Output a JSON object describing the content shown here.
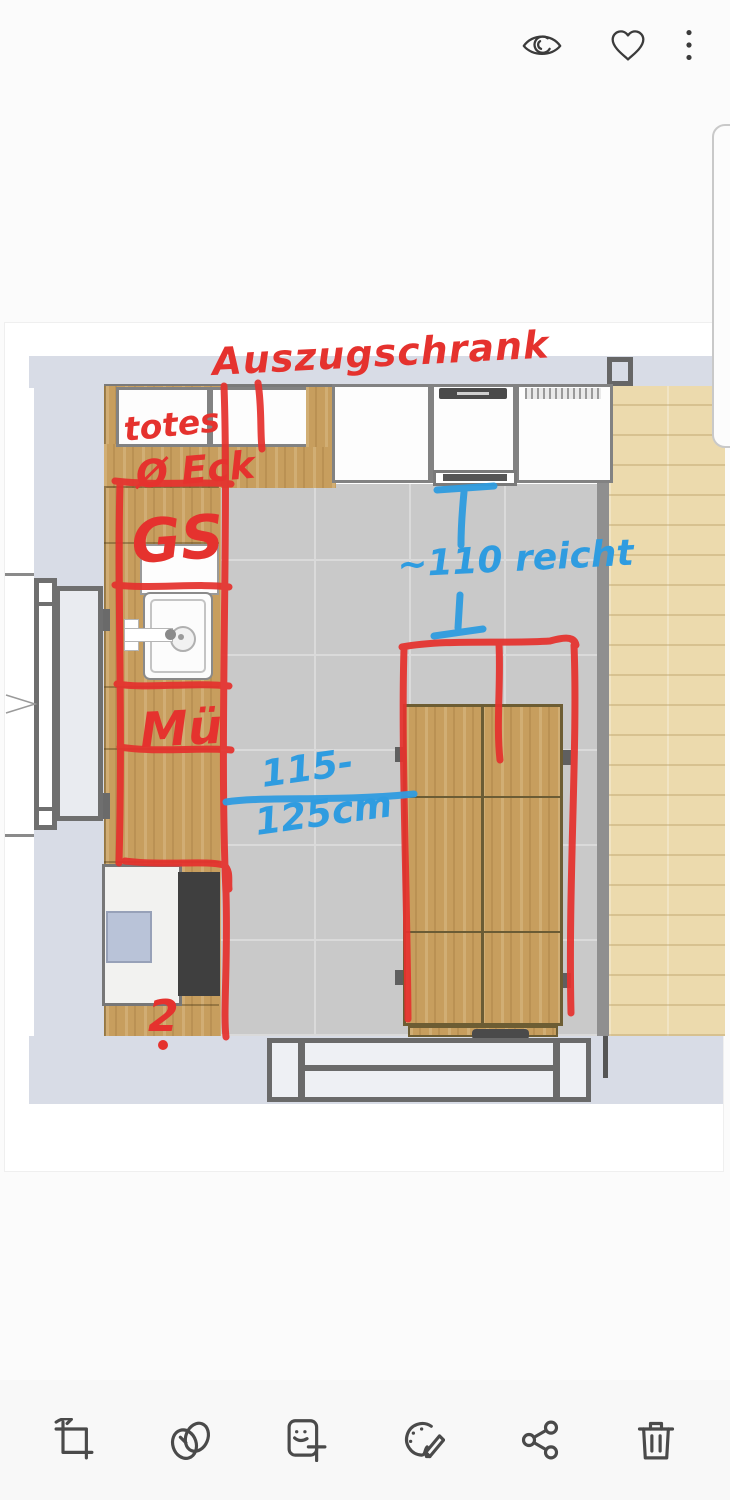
{
  "topbar": {
    "icons": [
      {
        "name": "vision-eye-icon"
      },
      {
        "name": "favorite-heart-icon"
      },
      {
        "name": "more-options-icon"
      }
    ]
  },
  "toolbar": {
    "icons": [
      {
        "name": "crop-rotate-icon"
      },
      {
        "name": "filters-icon"
      },
      {
        "name": "stickers-text-icon"
      },
      {
        "name": "draw-palette-icon"
      },
      {
        "name": "share-icon"
      },
      {
        "name": "delete-trash-icon"
      }
    ]
  },
  "annotations": {
    "red": {
      "color": "#e5322e",
      "pullout_cabinet": "Auszugschrank",
      "dead_corner_line1": "totes",
      "dead_corner_line2": "Ø Eck",
      "dishwasher": "GS",
      "trash_cabinet": "Mü",
      "count": "2"
    },
    "blue": {
      "color": "#2f9ce0",
      "clearance": "~110 reicht",
      "range_line1": "115-",
      "range_line2": "125cm"
    }
  },
  "plan": {
    "colors": {
      "wall": "#d8dce6",
      "tile_floor": "#c9c9c9",
      "counter_wood": "#c79e5e",
      "adjacent_room_floor": "#ecdaad",
      "appliance_dark": "#3f3f3f",
      "appliance_blue": "#b9c3d8"
    }
  }
}
